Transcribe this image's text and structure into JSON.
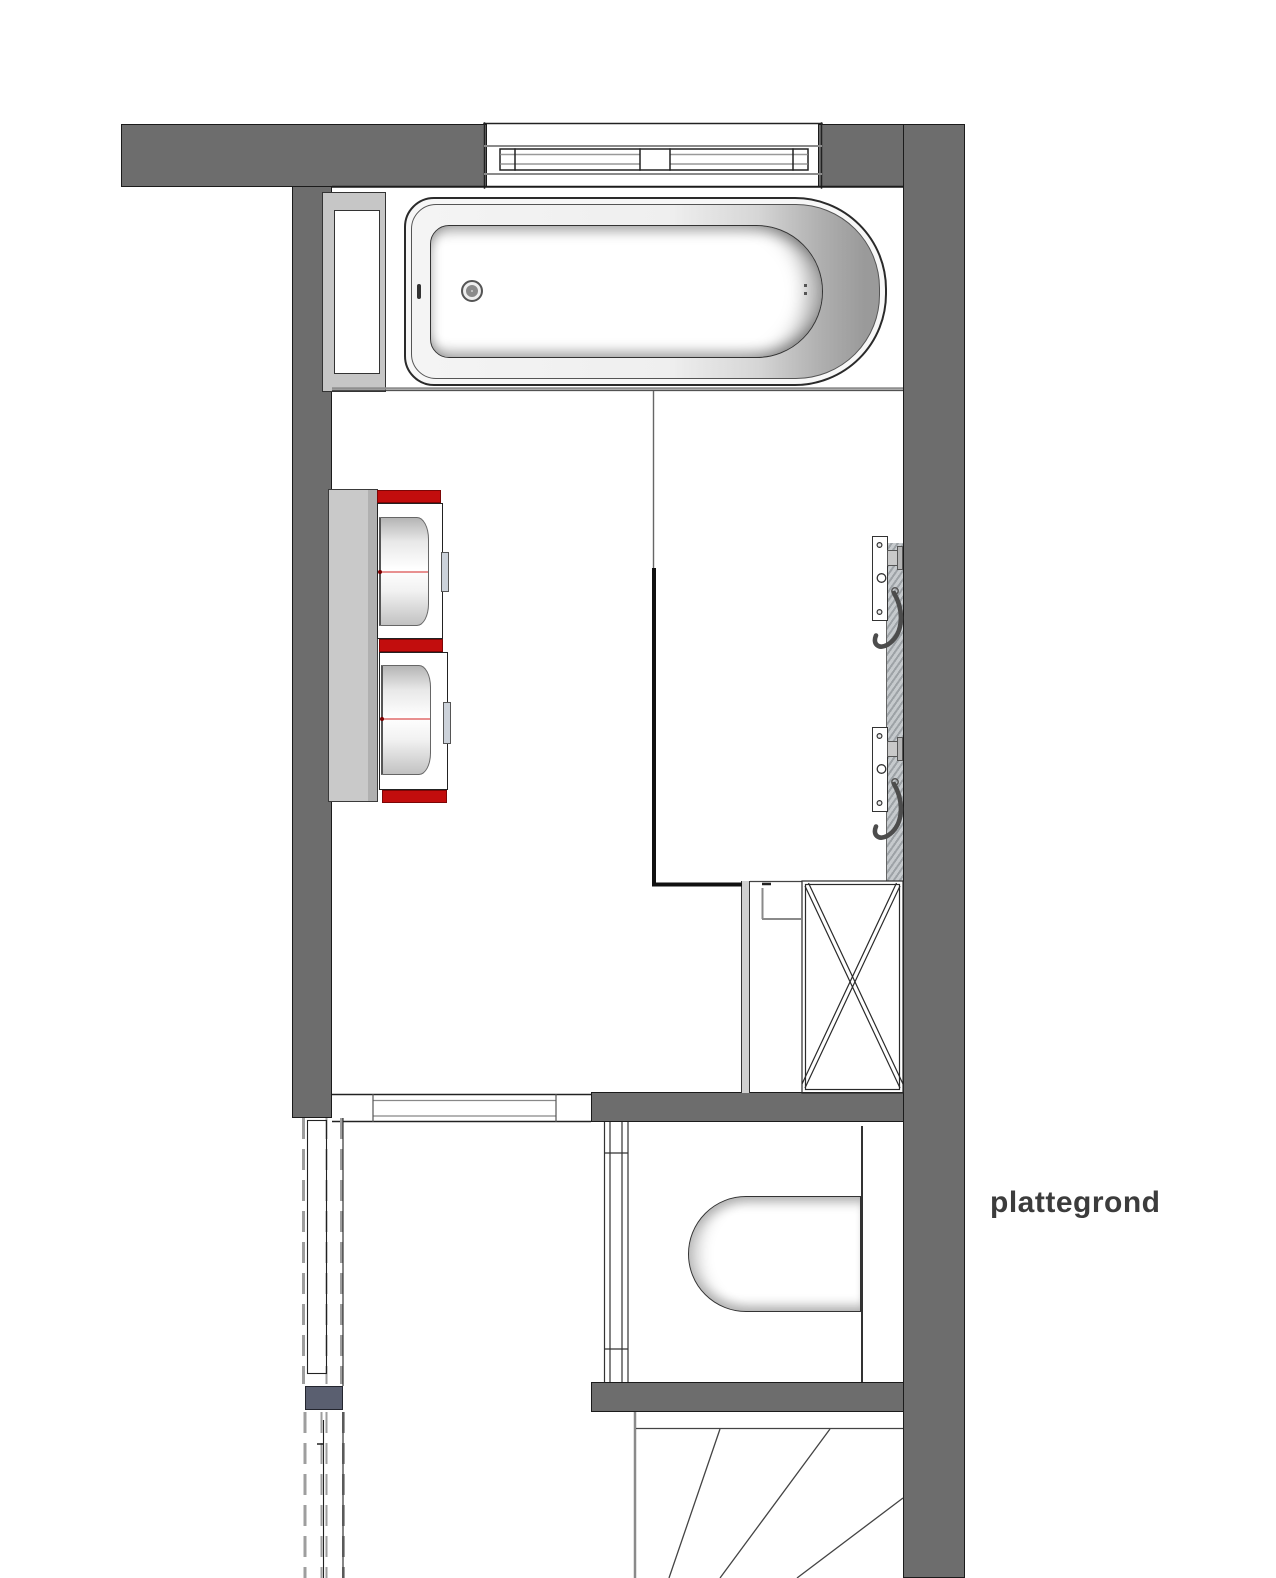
{
  "title": {
    "label": "plattegrond"
  },
  "colors": {
    "wall": "#6d6d6d",
    "line": "#222222",
    "panel-gray": "#c9c9c9",
    "accent-red": "#c20d0d",
    "red-edge": "#7c0606",
    "slate": "#5a5f70",
    "tile": "#b9bdc0",
    "text": "#3c3c3c"
  },
  "fixtures": {
    "bathtub": "bathtub-icon",
    "window": "window-icon",
    "niche": "storage-niche-icon",
    "washer_stack": "washer-dryer-icon",
    "shower_valves": "shower-valve-icon",
    "shaft": "shaft-cross-icon",
    "toilet": "toilet-icon",
    "stairs": "winder-stairs-icon",
    "sliding_door": "sliding-door-icon"
  }
}
